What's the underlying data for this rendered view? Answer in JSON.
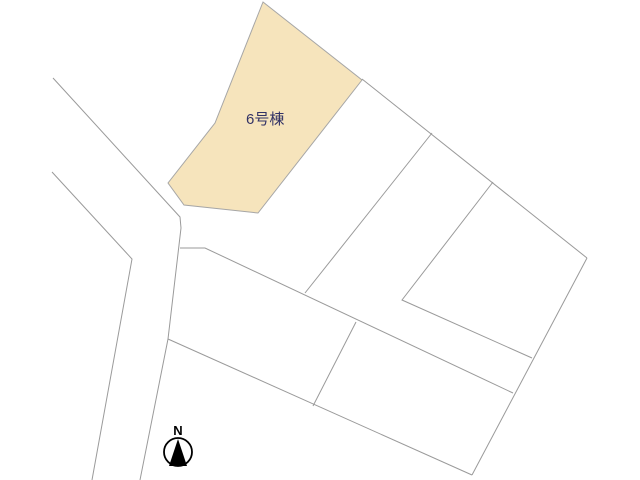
{
  "map": {
    "background_color": "#ffffff",
    "line_color": "#9a9a9a",
    "highlight_parcel": {
      "label": "6号棟",
      "fill_color": "#f6e4bc",
      "stroke_color": "#a6a6a6",
      "label_color": "#333366",
      "points": [
        [
          263,
          2
        ],
        [
          362,
          80
        ],
        [
          258,
          213
        ],
        [
          184,
          205
        ],
        [
          168,
          183
        ],
        [
          215,
          123
        ]
      ],
      "label_pos": [
        246,
        124
      ]
    },
    "boundaries": [
      {
        "name": "road-west-edge",
        "points": [
          [
            52,
            172
          ],
          [
            132,
            259
          ],
          [
            92,
            480
          ]
        ]
      },
      {
        "name": "road-east-edge",
        "points": [
          [
            53,
            78
          ],
          [
            180,
            217
          ],
          [
            181,
            228
          ],
          [
            168,
            339
          ],
          [
            140,
            480
          ]
        ]
      },
      {
        "name": "block-north-boundary",
        "points": [
          [
            362,
            79
          ],
          [
            587,
            258
          ]
        ]
      },
      {
        "name": "block-east-boundary",
        "points": [
          [
            587,
            258
          ],
          [
            472,
            475
          ]
        ]
      },
      {
        "name": "block-south-boundary",
        "points": [
          [
            168,
            339
          ],
          [
            472,
            475
          ]
        ]
      },
      {
        "name": "division-line-1",
        "points": [
          [
            432,
            133
          ],
          [
            305,
            293
          ]
        ]
      },
      {
        "name": "division-line-2",
        "points": [
          [
            493,
            182
          ],
          [
            402,
            300
          ],
          [
            532,
            358
          ]
        ]
      },
      {
        "name": "division-line-3",
        "points": [
          [
            180,
            248
          ],
          [
            205,
            248
          ],
          [
            513,
            393
          ]
        ]
      },
      {
        "name": "division-line-4",
        "points": [
          [
            356,
            322
          ],
          [
            313,
            406
          ]
        ]
      }
    ],
    "compass": {
      "label": "N",
      "center": [
        178,
        452
      ],
      "radius": 14,
      "needle_points": [
        [
          178,
          439
        ],
        [
          169,
          466
        ],
        [
          187,
          466
        ]
      ],
      "label_pos": [
        178,
        435
      ],
      "color": "#000000"
    }
  }
}
